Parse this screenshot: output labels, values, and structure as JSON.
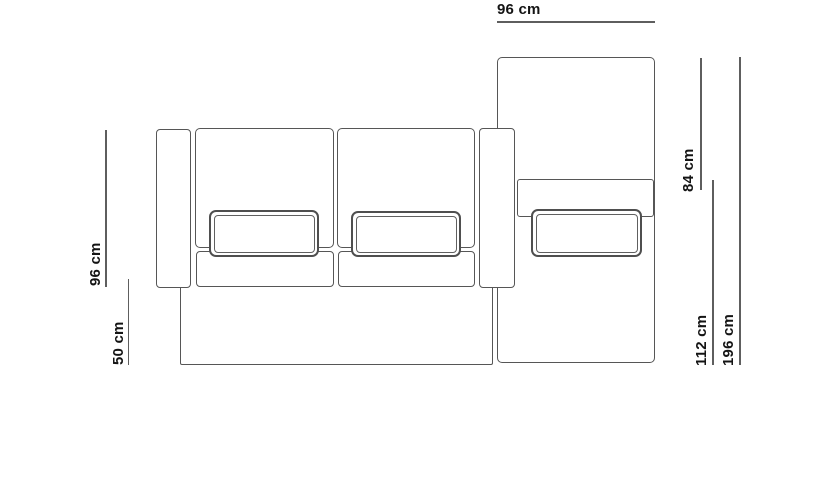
{
  "diagram": {
    "background_color": "#ffffff",
    "line_color": "#5e5e5e",
    "outline_color": "#565656",
    "text_color": "#141414",
    "dimensions": [
      {
        "id": "chaise-width",
        "label": "96 cm",
        "orientation": "horizontal",
        "edge": "top"
      },
      {
        "id": "sofa-depth",
        "label": "96 cm",
        "orientation": "vertical",
        "edge": "left"
      },
      {
        "id": "base-depth",
        "label": "50 cm",
        "orientation": "vertical",
        "edge": "left"
      },
      {
        "id": "chaise-back-length",
        "label": "84 cm",
        "orientation": "vertical",
        "edge": "right"
      },
      {
        "id": "chaise-seat-length",
        "label": "112 cm",
        "orientation": "vertical",
        "edge": "right"
      },
      {
        "id": "chaise-total-length",
        "label": "196 cm",
        "orientation": "vertical",
        "edge": "right"
      }
    ]
  }
}
